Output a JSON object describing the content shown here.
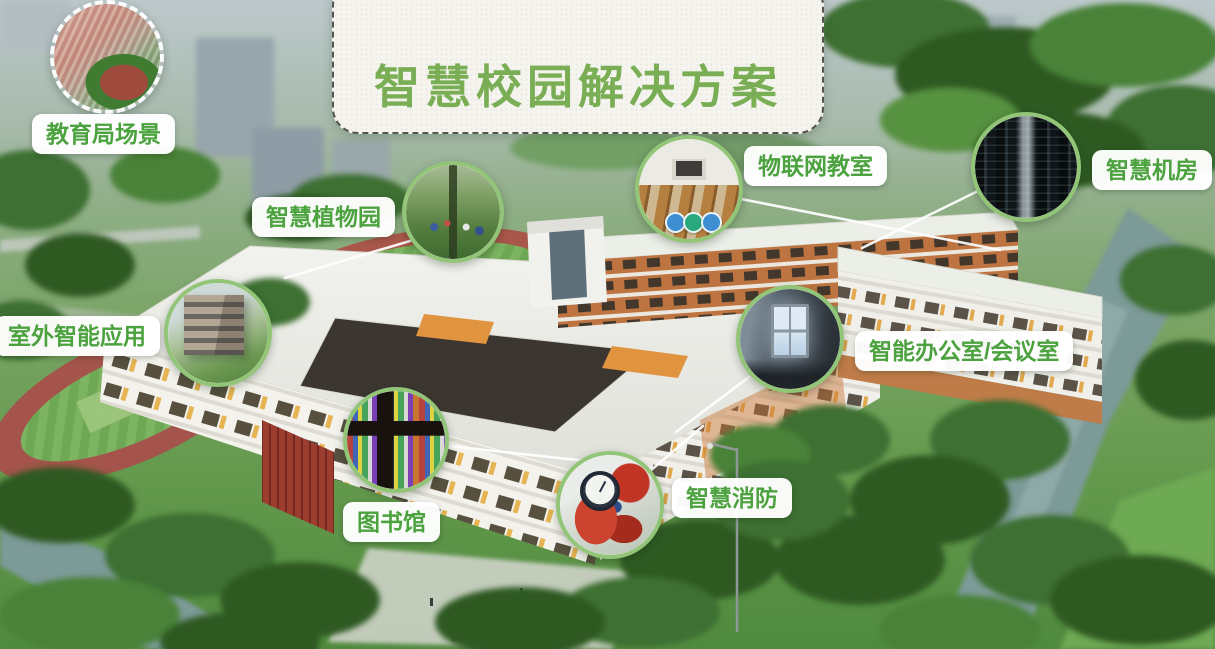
{
  "title": {
    "text": "智慧校园解决方案"
  },
  "colors": {
    "title_green": "#79ae55",
    "label_green": "#4ba23e",
    "ring_green": "#93c579",
    "banner_background": "#f5f4ef"
  },
  "callouts": [
    {
      "id": "education-bureau-scene",
      "label": "教育局场景",
      "image": "school-campus-aerial-photo"
    },
    {
      "id": "smart-botanical-garden",
      "label": "智慧植物园",
      "image": "botanical-garden-photo"
    },
    {
      "id": "iot-classroom",
      "label": "物联网教室",
      "image": "classroom-interior-photo"
    },
    {
      "id": "smart-server-room",
      "label": "智慧机房",
      "image": "server-racks-photo"
    },
    {
      "id": "outdoor-smart-apps",
      "label": "室外智能应用",
      "image": "campus-building-exterior-photo"
    },
    {
      "id": "smart-office-meeting",
      "label": "智能办公室/会议室",
      "image": "meeting-room-photo"
    },
    {
      "id": "library",
      "label": "图书馆",
      "image": "bookshelf-photo"
    },
    {
      "id": "smart-fire-protection",
      "label": "智慧消防",
      "image": "fire-equipment-photo"
    }
  ]
}
